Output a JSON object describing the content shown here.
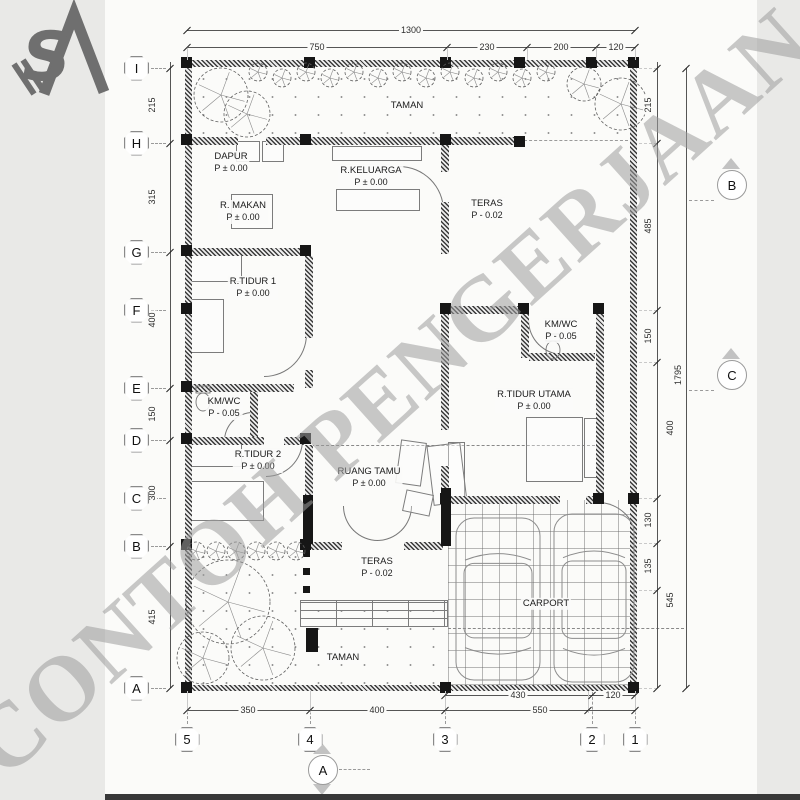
{
  "watermark": "CONTOH PENGERJAAN",
  "logo": {
    "icon": "sa-monogram-logo",
    "letters": "SA"
  },
  "colors": {
    "sheet": "#fbfbf9",
    "margin": "#e9e9e7",
    "line": "#3a3a3a",
    "dim": "#2e2e2e",
    "watermark": "#9d9d9d",
    "wall": "#161616",
    "bottom_bar": "#383838"
  },
  "grid": {
    "rows": [
      {
        "label": "I",
        "y": 68
      },
      {
        "label": "H",
        "y": 143
      },
      {
        "label": "G",
        "y": 252
      },
      {
        "label": "F",
        "y": 310
      },
      {
        "label": "E",
        "y": 388
      },
      {
        "label": "D",
        "y": 440
      },
      {
        "label": "C",
        "y": 498
      },
      {
        "label": "B",
        "y": 546
      },
      {
        "label": "A",
        "y": 688
      }
    ],
    "cols": [
      {
        "label": "5",
        "x": 187
      },
      {
        "label": "4",
        "x": 310
      },
      {
        "label": "3",
        "x": 445
      },
      {
        "label": "2",
        "x": 592
      },
      {
        "label": "1",
        "x": 635
      }
    ]
  },
  "rooms": [
    {
      "name": "TAMAN",
      "level": "",
      "x": 407,
      "y": 106
    },
    {
      "name": "DAPUR",
      "level": "P ± 0.00",
      "x": 231,
      "y": 163
    },
    {
      "name": "R.KELUARGA",
      "level": "P ± 0.00",
      "x": 371,
      "y": 177
    },
    {
      "name": "R. MAKAN",
      "level": "P ± 0.00",
      "x": 243,
      "y": 212
    },
    {
      "name": "TERAS",
      "level": "P - 0.02",
      "x": 487,
      "y": 210
    },
    {
      "name": "R.TIDUR 1",
      "level": "P ± 0.00",
      "x": 253,
      "y": 288
    },
    {
      "name": "KM/WC",
      "level": "P - 0.05",
      "x": 224,
      "y": 408
    },
    {
      "name": "KM/WC",
      "level": "P - 0.05",
      "x": 561,
      "y": 331
    },
    {
      "name": "R.TIDUR UTAMA",
      "level": "P ± 0.00",
      "x": 534,
      "y": 401
    },
    {
      "name": "R.TIDUR 2",
      "level": "P ± 0.00",
      "x": 258,
      "y": 461
    },
    {
      "name": "RUANG TAMU",
      "level": "P ± 0.00",
      "x": 369,
      "y": 478
    },
    {
      "name": "TERAS",
      "level": "P - 0.02",
      "x": 377,
      "y": 568
    },
    {
      "name": "CARPORT",
      "level": "",
      "x": 546,
      "y": 604
    },
    {
      "name": "TAMAN",
      "level": "",
      "x": 343,
      "y": 658
    }
  ],
  "dimensions": {
    "top_total": {
      "label": "1300",
      "y": 30,
      "x1": 187,
      "x2": 635
    },
    "top_chain": {
      "y": 47,
      "ticks": [
        187,
        447,
        527,
        596,
        635
      ],
      "labels": [
        {
          "text": "750",
          "x": 317
        },
        {
          "text": "230",
          "x": 487
        },
        {
          "text": "200",
          "x": 561
        },
        {
          "text": "120",
          "x": 616
        }
      ]
    },
    "bottom_inner": {
      "y": 695,
      "ticks": [
        445,
        592,
        635
      ],
      "labels": [
        {
          "text": "430",
          "x": 518
        },
        {
          "text": "120",
          "x": 613
        }
      ]
    },
    "bottom_chain": {
      "y": 710,
      "ticks": [
        187,
        310,
        445,
        588,
        635
      ],
      "labels": [
        {
          "text": "350",
          "x": 248
        },
        {
          "text": "400",
          "x": 377
        },
        {
          "text": "550",
          "x": 540
        }
      ]
    },
    "left_chain": {
      "x": 170,
      "ticks": [
        68,
        143,
        252,
        388,
        440,
        546,
        688
      ],
      "labels": [
        {
          "text": "215",
          "y": 105
        },
        {
          "text": "315",
          "y": 197
        },
        {
          "text": "400",
          "y": 320
        },
        {
          "text": "150",
          "y": 414
        },
        {
          "text": "300",
          "y": 493
        },
        {
          "text": "415",
          "y": 617
        }
      ]
    },
    "right_chain": {
      "x": 657,
      "ticks": [
        68,
        143,
        310,
        362,
        498,
        543,
        590,
        688
      ],
      "labels": [
        {
          "text": "215",
          "y": 105
        },
        {
          "text": "485",
          "y": 226
        },
        {
          "text": "150",
          "y": 336
        },
        {
          "text": "130",
          "y": 520
        },
        {
          "text": "135",
          "y": 566
        }
      ]
    },
    "right_chain2": {
      "x": 670,
      "labels": [
        {
          "text": "400",
          "y": 428
        },
        {
          "text": "545",
          "y": 600
        }
      ]
    },
    "right_total": {
      "label": "1795",
      "x": 686,
      "y1": 68,
      "y2": 688,
      "label_y": 375
    }
  },
  "section_markers": [
    {
      "label": "B",
      "x": 731,
      "y": 184
    },
    {
      "label": "C",
      "x": 731,
      "y": 374
    },
    {
      "label": "A",
      "x": 322,
      "y": 769
    }
  ]
}
